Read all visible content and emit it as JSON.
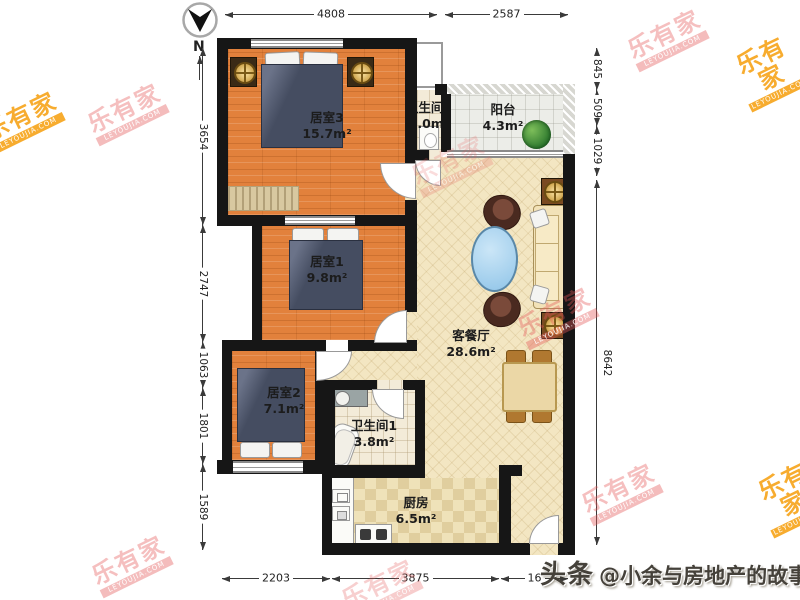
{
  "compass": {
    "north_label": "N"
  },
  "dimensions": {
    "top": [
      "4808",
      "2587"
    ],
    "bottom": [
      "2203",
      "3875",
      "16"
    ],
    "left": [
      "3654",
      "2747",
      "1063",
      "1801",
      "1589"
    ],
    "right": [
      "845",
      "509",
      "1029",
      "8642"
    ]
  },
  "rooms": [
    {
      "name": "居室3",
      "area": "15.7m²"
    },
    {
      "name": "卫生间2",
      "area": "3.0m²"
    },
    {
      "name": "阳台",
      "area": "4.3m²"
    },
    {
      "name": "居室1",
      "area": "9.8m²"
    },
    {
      "name": "客餐厅",
      "area": "28.6m²"
    },
    {
      "name": "居室2",
      "area": "7.1m²"
    },
    {
      "name": "卫生间1",
      "area": "3.8m²"
    },
    {
      "name": "厨房",
      "area": "6.5m²"
    }
  ],
  "watermark": {
    "text": "乐有家",
    "subtext": "LEYOUJIA.COM"
  },
  "credit": {
    "brand": "头条",
    "handle": "@小余与房地产的故事"
  },
  "colors": {
    "wall": "#161616",
    "wood_floor": "#E2813C",
    "living_floor": "#F3E6C2",
    "kitchen_floor": "#EFE2B9",
    "bed": "#454D61",
    "coffee_table": "#8FC4E8",
    "watermark_red": "#E45858",
    "watermark_orange": "#F69E0A"
  }
}
